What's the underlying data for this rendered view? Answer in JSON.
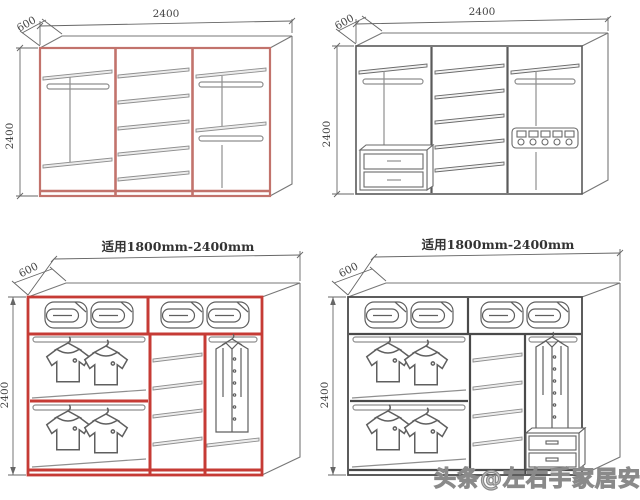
{
  "sheet": {
    "background": "#ffffff",
    "watermark": {
      "text": "头条@左右手家居安装",
      "color": "#9a9a9a"
    }
  },
  "colors": {
    "red_outline_light": "#c2736c",
    "red_outline_strong": "#c63b35",
    "dark_outline": "#555555",
    "detail_gray": "#8f8f8f"
  },
  "diagrams": [
    {
      "id": "wardrobe-2400-red-empty",
      "position": "top-left",
      "line_color": "#c2736c",
      "labels": {
        "width": "2400",
        "depth": "600",
        "height": "2400"
      },
      "features": [
        "left: top shelf + hanging rod + low shelf",
        "middle: 5 shelves",
        "right: two hanging rods with shelves"
      ]
    },
    {
      "id": "wardrobe-2400-black-empty",
      "position": "top-right",
      "line_color": "#555555",
      "labels": {
        "width": "2400",
        "depth": "600",
        "height": "2400"
      },
      "features": [
        "left: top shelf + hanging rod + 2 drawers",
        "middle: 5 shelves",
        "right: hanging rod + belt rack"
      ]
    },
    {
      "id": "wardrobe-fit-range-red-illustrated",
      "position": "bottom-left",
      "line_color": "#c63b35",
      "labels": {
        "fit": "适用1800mm-2400mm",
        "depth": "600",
        "height": "2400"
      },
      "features": [
        "top: quilt storage with 4 folded quilts",
        "left: double hanging sections with shirts",
        "middle: 4 shelves",
        "right: long-coat hanging + shelf"
      ]
    },
    {
      "id": "wardrobe-fit-range-black-illustrated",
      "position": "bottom-right",
      "line_color": "#4a4a4a",
      "labels": {
        "fit": "适用1800mm-2400mm",
        "depth": "600",
        "height": "2400"
      },
      "features": [
        "top: quilt storage with 4 folded quilts",
        "left: double hanging sections with shirts",
        "middle: 4 shelves",
        "right: long-coat hanging + drawer unit"
      ]
    }
  ]
}
